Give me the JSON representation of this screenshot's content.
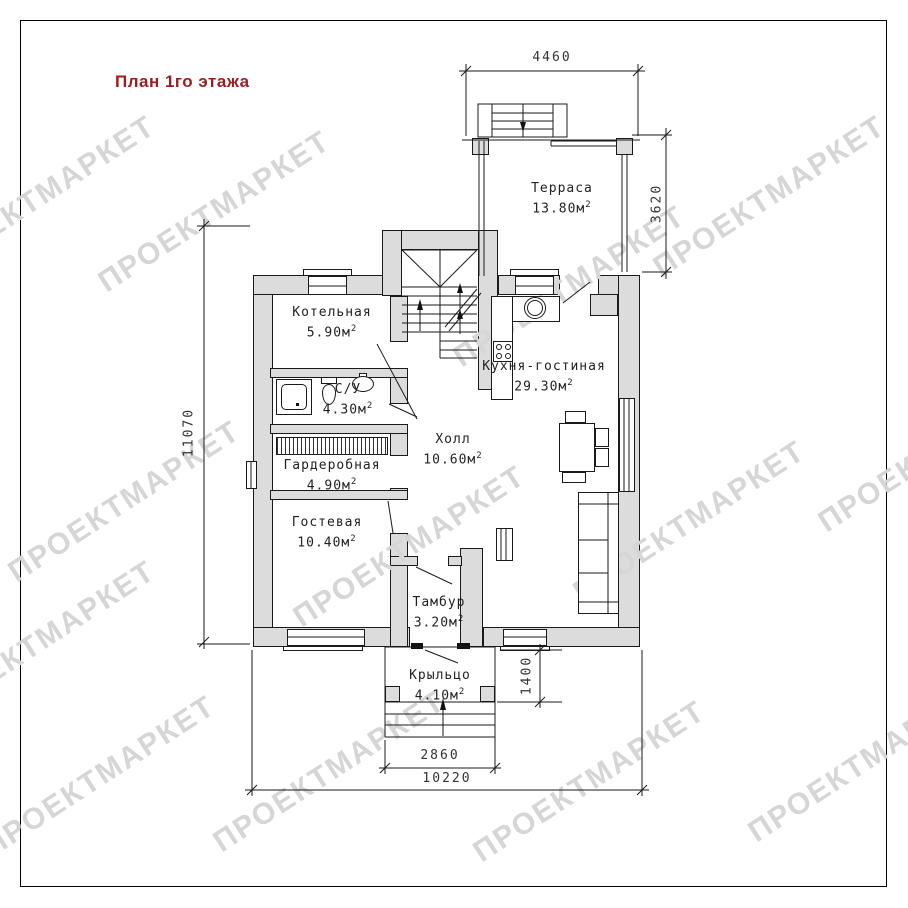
{
  "title": "План 1го этажа",
  "watermark": {
    "text": "ПРОЕКТМАРКЕТ"
  },
  "area_superscript": "2",
  "rooms": [
    {
      "id": "terrace",
      "name": "Терраса",
      "area": "13.80м"
    },
    {
      "id": "boiler",
      "name": "Котельная",
      "area": "5.90м"
    },
    {
      "id": "bathroom",
      "name": "С/У",
      "area": "4.30м"
    },
    {
      "id": "wardrobe",
      "name": "Гардеробная",
      "area": "4.90м"
    },
    {
      "id": "guest",
      "name": "Гостевая",
      "area": "10.40м"
    },
    {
      "id": "hall",
      "name": "Холл",
      "area": "10.60м"
    },
    {
      "id": "kitchen",
      "name": "Кухня-гостиная",
      "area": "29.30м"
    },
    {
      "id": "vestibule",
      "name": "Тамбур",
      "area": "3.20м"
    },
    {
      "id": "porch",
      "name": "Крыльцо",
      "area": "4.10м"
    }
  ],
  "dimensions": {
    "terrace_width": "4460",
    "terrace_height": "3620",
    "house_height": "11070",
    "porch_depth": "1400",
    "porch_width": "2860",
    "house_width": "10220"
  },
  "colors": {
    "wall_fill": "#dcdcdc",
    "line": "#1a1a1a",
    "title": "#9b1d1d",
    "watermark": "#d6d6d6"
  }
}
